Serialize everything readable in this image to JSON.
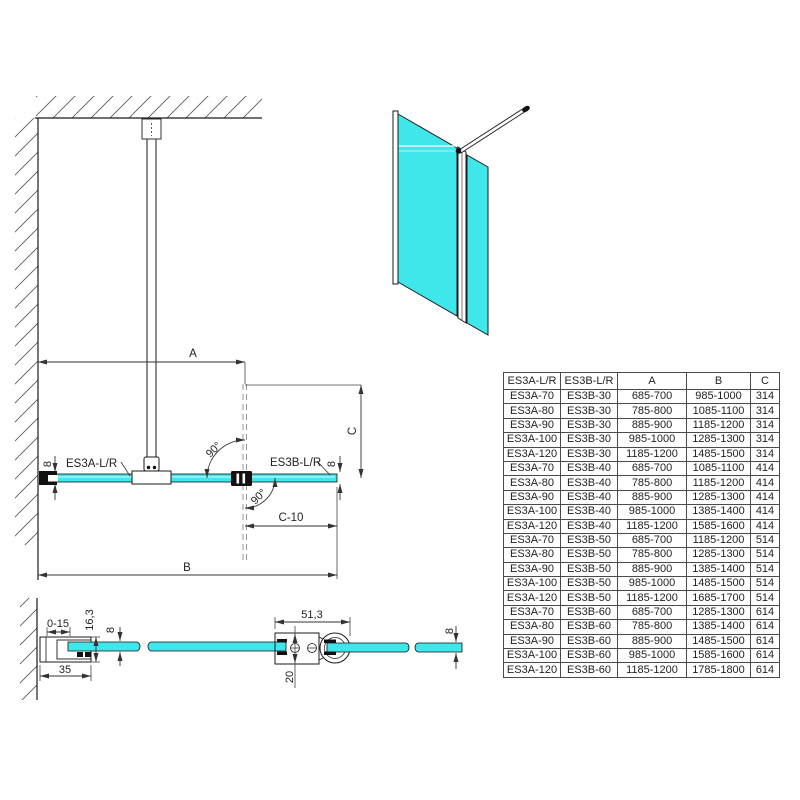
{
  "colors": {
    "glass": "#3fe7eb",
    "glass_highlight": "#b9f6f8",
    "line": "#1b1b1b"
  },
  "top_view": {
    "label_left_panel": "ES3A-L/R",
    "label_right_panel": "ES3B-L/R",
    "dim_a": "A",
    "dim_b": "B",
    "dim_c": "C",
    "dim_c_minus_10": "C-10",
    "angle_top": "90°",
    "angle_bottom": "90°",
    "glass_thickness_left": "8",
    "glass_thickness_right": "8"
  },
  "wall_profile_detail": {
    "adjustment_range": "0-15",
    "profile_depth": "16,3",
    "glass_thickness": "8",
    "profile_width": "35"
  },
  "connector_detail": {
    "profile_width": "51,3",
    "profile_height": "20",
    "glass_thickness": "8"
  },
  "size_table": {
    "headers": [
      "ES3A-L/R",
      "ES3B-L/R",
      "A",
      "B",
      "C"
    ],
    "rows": [
      [
        "ES3A-70",
        "ES3B-30",
        "685-700",
        "985-1000",
        "314"
      ],
      [
        "ES3A-80",
        "ES3B-30",
        "785-800",
        "1085-1100",
        "314"
      ],
      [
        "ES3A-90",
        "ES3B-30",
        "885-900",
        "1185-1200",
        "314"
      ],
      [
        "ES3A-100",
        "ES3B-30",
        "985-1000",
        "1285-1300",
        "314"
      ],
      [
        "ES3A-120",
        "ES3B-30",
        "1185-1200",
        "1485-1500",
        "314"
      ],
      [
        "ES3A-70",
        "ES3B-40",
        "685-700",
        "1085-1100",
        "414"
      ],
      [
        "ES3A-80",
        "ES3B-40",
        "785-800",
        "1185-1200",
        "414"
      ],
      [
        "ES3A-90",
        "ES3B-40",
        "885-900",
        "1285-1300",
        "414"
      ],
      [
        "ES3A-100",
        "ES3B-40",
        "985-1000",
        "1385-1400",
        "414"
      ],
      [
        "ES3A-120",
        "ES3B-40",
        "1185-1200",
        "1585-1600",
        "414"
      ],
      [
        "ES3A-70",
        "ES3B-50",
        "685-700",
        "1185-1200",
        "514"
      ],
      [
        "ES3A-80",
        "ES3B-50",
        "785-800",
        "1285-1300",
        "514"
      ],
      [
        "ES3A-90",
        "ES3B-50",
        "885-900",
        "1385-1400",
        "514"
      ],
      [
        "ES3A-100",
        "ES3B-50",
        "985-1000",
        "1485-1500",
        "514"
      ],
      [
        "ES3A-120",
        "ES3B-50",
        "1185-1200",
        "1685-1700",
        "514"
      ],
      [
        "ES3A-70",
        "ES3B-60",
        "685-700",
        "1285-1300",
        "614"
      ],
      [
        "ES3A-80",
        "ES3B-60",
        "785-800",
        "1385-1400",
        "614"
      ],
      [
        "ES3A-90",
        "ES3B-60",
        "885-900",
        "1485-1500",
        "614"
      ],
      [
        "ES3A-100",
        "ES3B-60",
        "985-1000",
        "1585-1600",
        "614"
      ],
      [
        "ES3A-120",
        "ES3B-60",
        "1185-1200",
        "1785-1800",
        "614"
      ]
    ]
  }
}
